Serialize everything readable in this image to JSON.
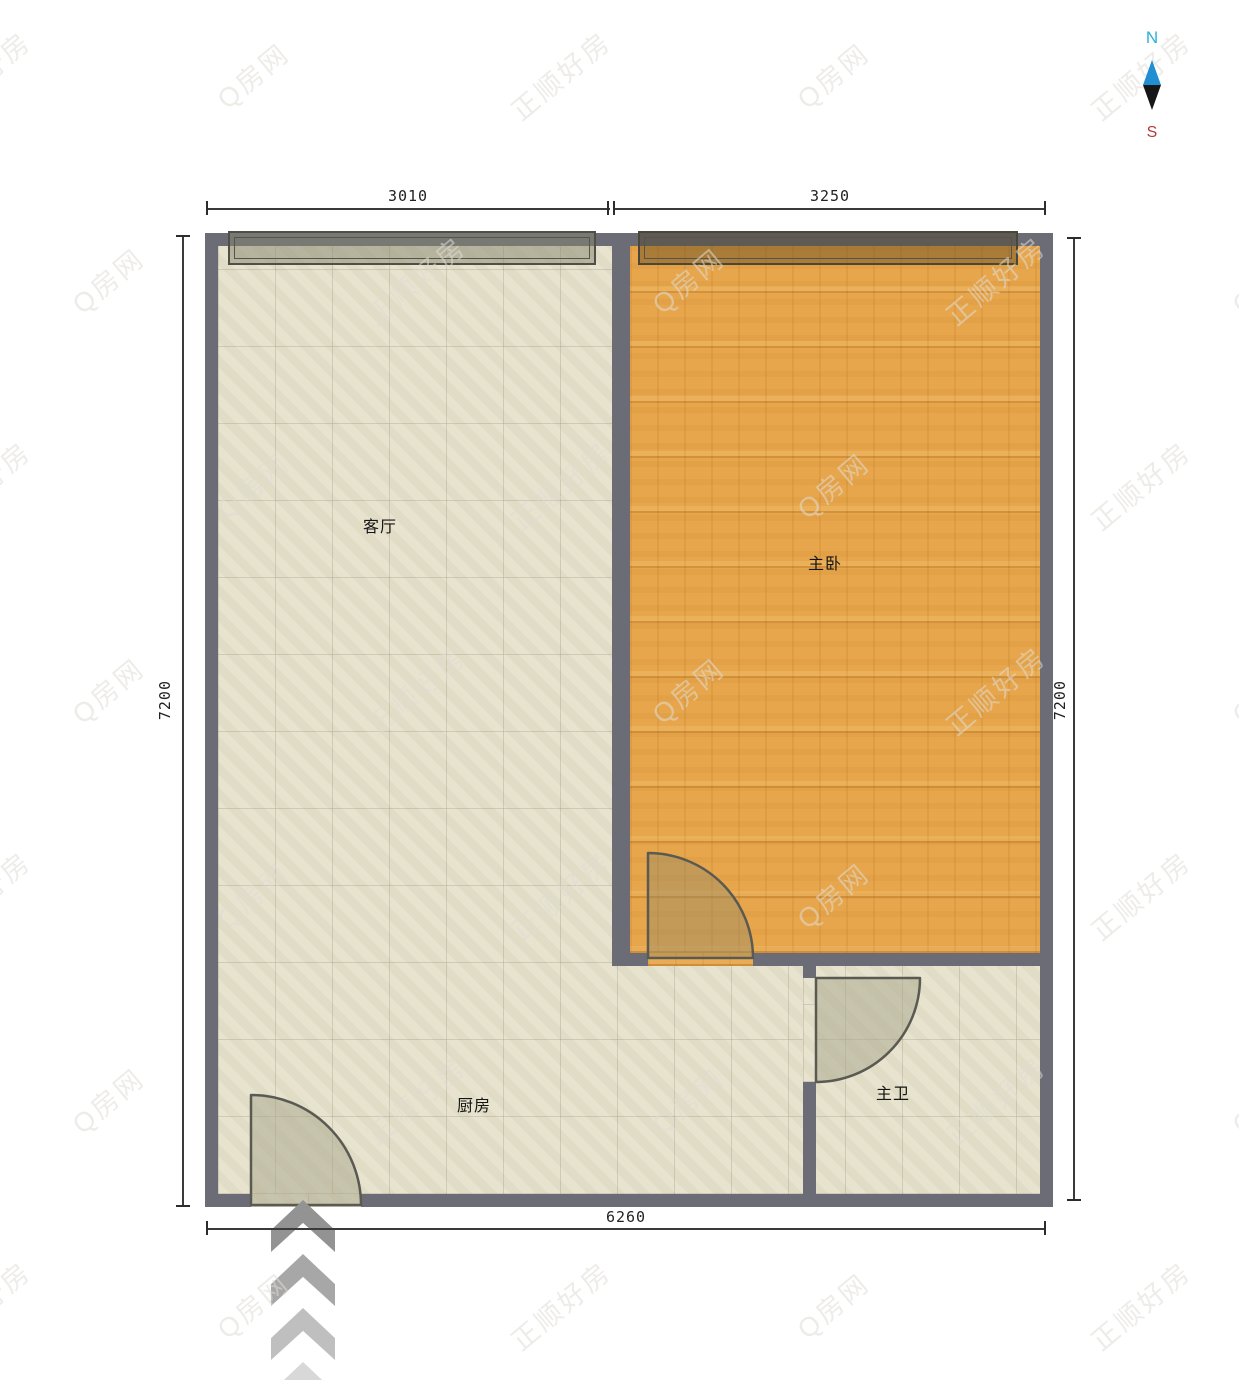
{
  "title": "户型图",
  "compass": {
    "north_label": "N",
    "south_label": "S",
    "north_color": "#29b0d8",
    "south_color": "#b23b3b",
    "needle_north_color": "#1f8fd1",
    "needle_south_color": "#161616"
  },
  "dimensions": {
    "top_left_width": "3010",
    "top_right_width": "3250",
    "left_height": "7200",
    "right_height": "7200",
    "bottom_width": "6260"
  },
  "rooms": {
    "living": {
      "label": "客厅"
    },
    "bedroom": {
      "label": "主卧"
    },
    "kitchen": {
      "label": "厨房"
    },
    "bathroom": {
      "label": "主卫"
    }
  },
  "watermark": {
    "primary": "正顺好房",
    "secondary": "Q房网"
  },
  "colors": {
    "wall": "#6c6c77",
    "tile_floor": "#e4e0ca",
    "wood_floor": "#e7a64c",
    "dimension_line": "#3a3a3a"
  }
}
